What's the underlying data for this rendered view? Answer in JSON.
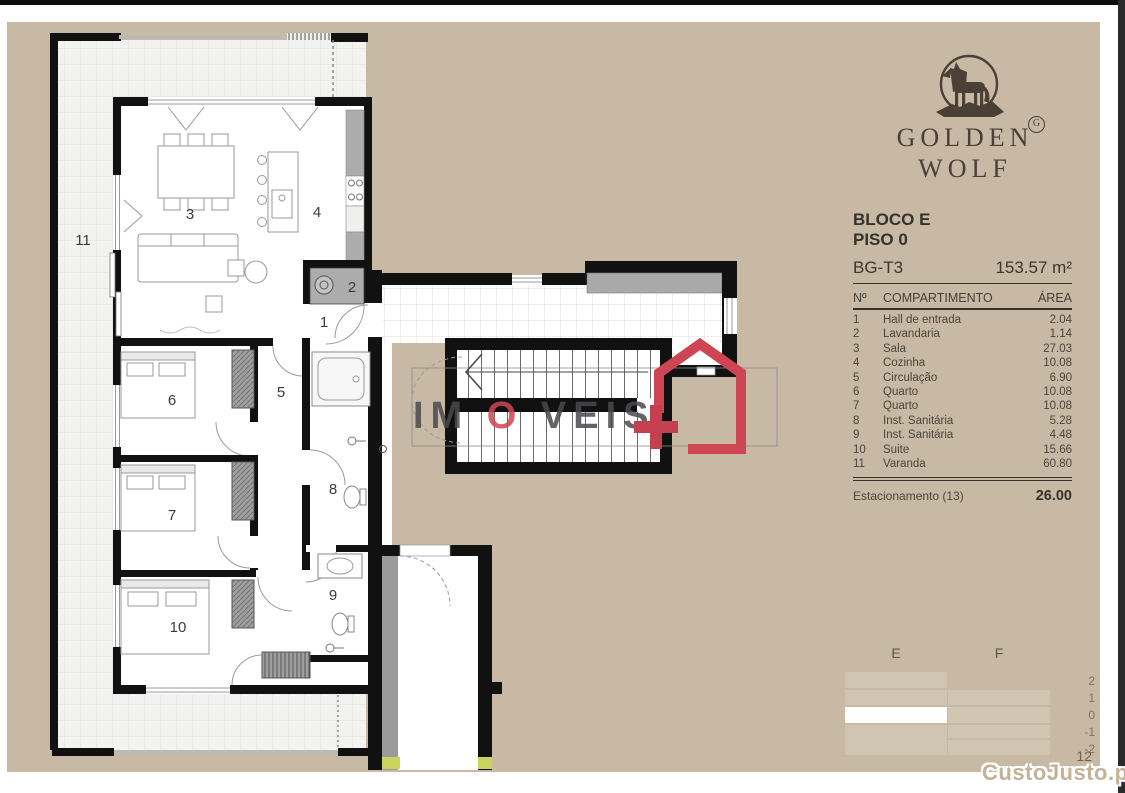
{
  "brand": {
    "name_line1": "GOLDEN",
    "name_line2": "WOLF",
    "mark": "G",
    "logo_color": "#4b4036"
  },
  "header": {
    "block": "BLOCO E",
    "floor": "PISO 0",
    "unit": "BG-T3",
    "total_area": "153.57 m²"
  },
  "table": {
    "col_n": "Nº",
    "col_comp": "COMPARTIMENTO",
    "col_area": "ÁREA",
    "rows": [
      {
        "n": "1",
        "name": "Hall de entrada",
        "area": "2.04"
      },
      {
        "n": "2",
        "name": "Lavandaria",
        "area": "1.14"
      },
      {
        "n": "3",
        "name": "Sala",
        "area": "27.03"
      },
      {
        "n": "4",
        "name": "Cozinha",
        "area": "10.08"
      },
      {
        "n": "5",
        "name": "Circulação",
        "area": "6.90"
      },
      {
        "n": "6",
        "name": "Quarto",
        "area": "10.08"
      },
      {
        "n": "7",
        "name": "Quarto",
        "area": "10.08"
      },
      {
        "n": "8",
        "name": "Inst. Sanitária",
        "area": "5.28"
      },
      {
        "n": "9",
        "name": "Inst. Sanitária",
        "area": "4.48"
      },
      {
        "n": "10",
        "name": "Suite",
        "area": "15.66"
      },
      {
        "n": "11",
        "name": "Varanda",
        "area": "60.80"
      }
    ],
    "footer": {
      "label": "Estacionamento (13)",
      "area": "26.00"
    }
  },
  "plan": {
    "labels": [
      "1",
      "2",
      "3",
      "4",
      "5",
      "6",
      "7",
      "8",
      "9",
      "10",
      "11"
    ],
    "wall_color": "#111111",
    "accent_red": "#ce4553"
  },
  "elevation": {
    "col_e": "E",
    "col_f": "F",
    "levels": [
      "2",
      "1",
      "0",
      "-1",
      "-2"
    ],
    "highlighted": "E level 0",
    "page_number": "12"
  },
  "watermarks": {
    "center_part1": "IM",
    "center_part2": "O",
    "center_part3": "VEIS",
    "bottom_right": "CustoJusto.pt"
  }
}
